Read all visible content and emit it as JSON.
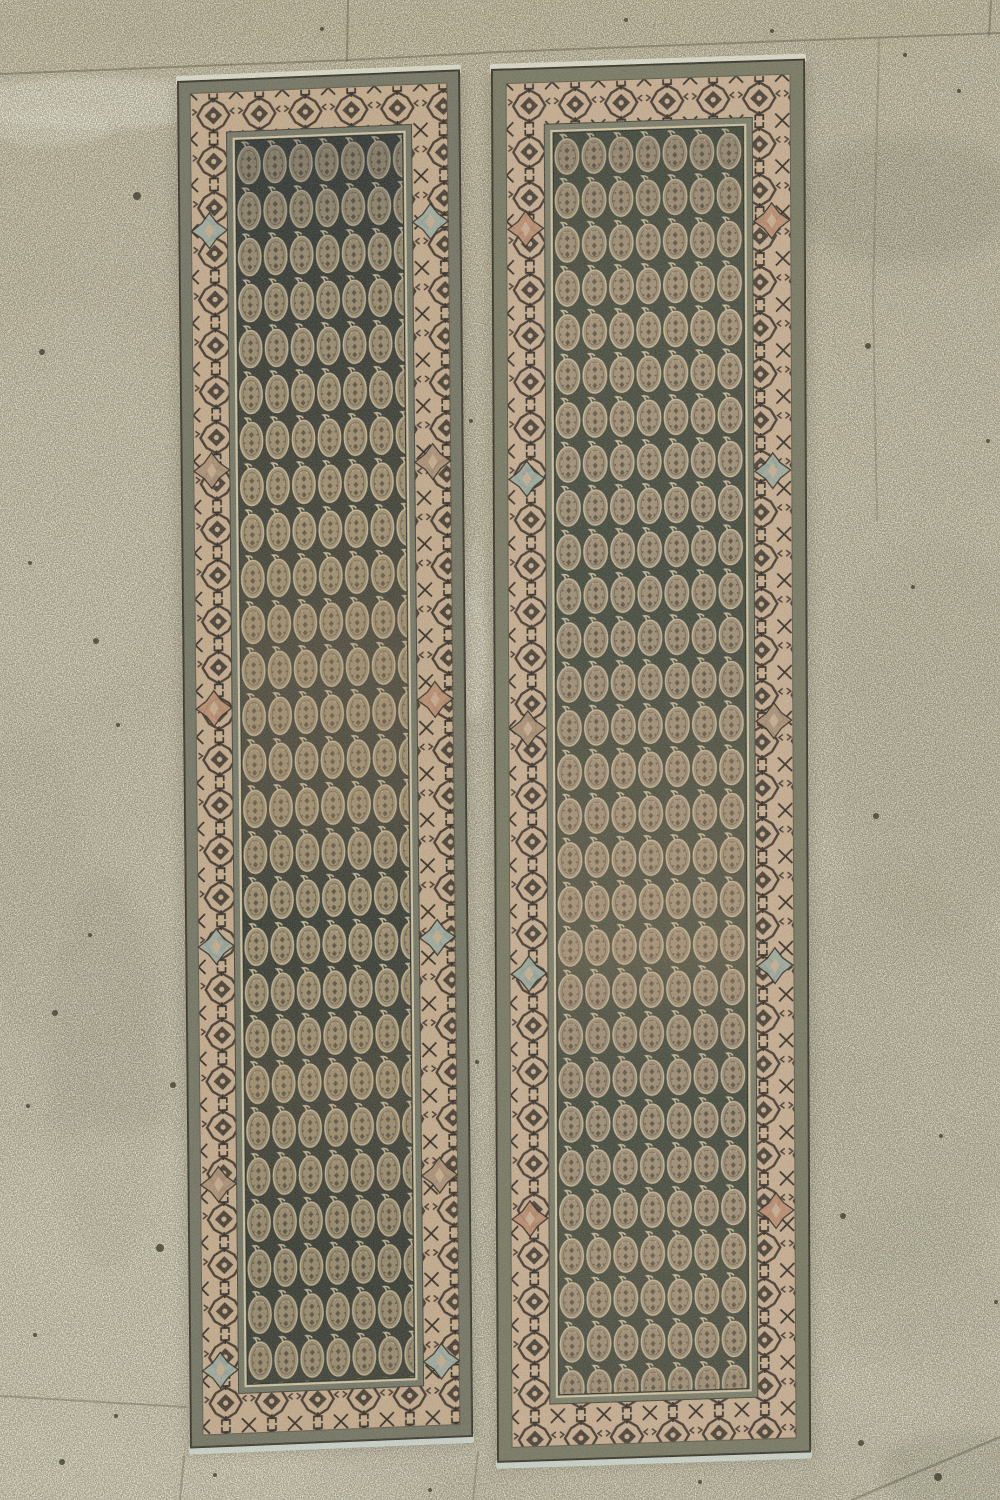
{
  "meta": {
    "description": "Photograph of a pair of antique Persian paisley-pattern runner rugs lying side by side on a speckled concrete floor",
    "canvas_width": 1000,
    "canvas_height": 1500
  },
  "floor": {
    "gradient": [
      "#b0a786",
      "#b6b094",
      "#bdb89f"
    ],
    "grout_color": "#5f5c49",
    "grout_lines": [
      {
        "points": [
          [
            0,
            74
          ],
          [
            350,
            60
          ],
          [
            500,
            52
          ],
          [
            760,
            42
          ],
          [
            1000,
            33
          ]
        ],
        "width": 2,
        "opacity": 0.5
      },
      {
        "points": [
          [
            348,
            0
          ],
          [
            347,
            61
          ]
        ],
        "width": 2,
        "opacity": 0.5
      },
      {
        "points": [
          [
            879,
            40
          ],
          [
            873,
            300
          ],
          [
            877,
            520
          ]
        ],
        "width": 2,
        "opacity": 0.3
      },
      {
        "points": [
          [
            991,
            0
          ],
          [
            989,
            35
          ]
        ],
        "width": 2,
        "opacity": 0.5
      },
      {
        "points": [
          [
            0,
            1396
          ],
          [
            186,
            1407
          ]
        ],
        "width": 2,
        "opacity": 0.4
      },
      {
        "points": [
          [
            184,
            1456
          ],
          [
            180,
            1500
          ]
        ],
        "width": 2,
        "opacity": 0.4
      },
      {
        "points": [
          [
            478,
            1452
          ],
          [
            473,
            1500
          ]
        ],
        "width": 2,
        "opacity": 0.35
      },
      {
        "points": [
          [
            852,
            1500
          ],
          [
            1000,
            1437
          ]
        ],
        "width": 2.5,
        "opacity": 0.45
      }
    ],
    "patches": [
      {
        "cx": 95,
        "cy": 103,
        "rx": 130,
        "ry": 26,
        "c": "#e6e3d2",
        "o": 0.55,
        "b": 8
      },
      {
        "cx": 52,
        "cy": 128,
        "rx": 60,
        "ry": 18,
        "c": "#e6e3d2",
        "o": 0.4,
        "b": 8
      },
      {
        "cx": 905,
        "cy": 200,
        "rx": 110,
        "ry": 65,
        "c": "#65624a",
        "o": 0.3,
        "b": 24
      },
      {
        "cx": 700,
        "cy": 160,
        "rx": 60,
        "ry": 30,
        "c": "#6e6b51",
        "o": 0.12,
        "b": 24
      },
      {
        "cx": 60,
        "cy": 500,
        "rx": 110,
        "ry": 200,
        "c": "#c6c0a4",
        "o": 0.3,
        "b": 32
      },
      {
        "cx": 935,
        "cy": 740,
        "rx": 110,
        "ry": 200,
        "c": "#83805f",
        "o": 0.22,
        "b": 32
      },
      {
        "cx": 890,
        "cy": 1080,
        "rx": 130,
        "ry": 220,
        "c": "#83805f",
        "o": 0.16,
        "b": 32
      },
      {
        "cx": 105,
        "cy": 1075,
        "rx": 55,
        "ry": 200,
        "c": "#6f6c52",
        "o": 0.22,
        "b": 24
      },
      {
        "cx": 25,
        "cy": 880,
        "rx": 60,
        "ry": 150,
        "c": "#83805f",
        "o": 0.15,
        "b": 24
      },
      {
        "cx": 120,
        "cy": 1340,
        "rx": 240,
        "ry": 210,
        "c": "#ccc7ac",
        "o": 0.42,
        "b": 32
      },
      {
        "cx": 640,
        "cy": 1490,
        "rx": 230,
        "ry": 30,
        "c": "#a29a77",
        "o": 0.25,
        "b": 16
      },
      {
        "cx": 965,
        "cy": 1475,
        "rx": 85,
        "ry": 45,
        "c": "#6a674e",
        "o": 0.3,
        "b": 16
      },
      {
        "cx": 472,
        "cy": 655,
        "rx": 17,
        "ry": 65,
        "c": "#ded9c5",
        "o": 0.5,
        "b": 8
      },
      {
        "cx": 473,
        "cy": 580,
        "rx": 12,
        "ry": 40,
        "c": "#d5d1bd",
        "o": 0.35,
        "b": 8
      },
      {
        "cx": 500,
        "cy": 18,
        "rx": 540,
        "ry": 34,
        "c": "#9e9370",
        "o": 0.22,
        "b": 16
      },
      {
        "cx": 240,
        "cy": 1480,
        "rx": 200,
        "ry": 30,
        "c": "#c9c4a9",
        "o": 0.3,
        "b": 16
      },
      {
        "cx": 360,
        "cy": 55,
        "rx": 180,
        "ry": 18,
        "c": "#b4a685",
        "o": 0.2,
        "b": 16
      },
      {
        "cx": 30,
        "cy": 300,
        "rx": 50,
        "ry": 80,
        "c": "#a89f7d",
        "o": 0.15,
        "b": 24
      },
      {
        "cx": 860,
        "cy": 420,
        "rx": 70,
        "ry": 90,
        "c": "#b9b397",
        "o": 0.2,
        "b": 24
      },
      {
        "cx": 915,
        "cy": 1280,
        "rx": 90,
        "ry": 90,
        "c": "#8a8666",
        "o": 0.12,
        "b": 24
      }
    ],
    "specks": [
      [
        137,
        196,
        4
      ],
      [
        42,
        352,
        3
      ],
      [
        30,
        563,
        2
      ],
      [
        96,
        641,
        3
      ],
      [
        55,
        1013,
        3
      ],
      [
        160,
        1248,
        4
      ],
      [
        173,
        1085,
        3
      ],
      [
        28,
        1106,
        2
      ],
      [
        116,
        1416,
        2
      ],
      [
        62,
        1462,
        3
      ],
      [
        868,
        346,
        3
      ],
      [
        988,
        441,
        2
      ],
      [
        913,
        587,
        2
      ],
      [
        876,
        816,
        3
      ],
      [
        941,
        1136,
        2
      ],
      [
        843,
        1216,
        3
      ],
      [
        938,
        1477,
        4
      ],
      [
        861,
        1443,
        3
      ],
      [
        996,
        1302,
        2
      ],
      [
        471,
        421,
        2
      ],
      [
        477,
        1062,
        2
      ],
      [
        322,
        29,
        2
      ],
      [
        626,
        20,
        2
      ],
      [
        959,
        91,
        2
      ],
      [
        772,
        31,
        2
      ],
      [
        905,
        55,
        2
      ],
      [
        118,
        725,
        2
      ],
      [
        90,
        935,
        2
      ],
      [
        35,
        1335,
        2
      ],
      [
        215,
        1475,
        2
      ],
      [
        700,
        1482,
        2
      ],
      [
        430,
        1490,
        2
      ]
    ],
    "speck_color": "#32301f"
  },
  "rugs": [
    {
      "name": "left-runner-rug",
      "x": 178,
      "y": 82,
      "width": 281,
      "height": 1366,
      "skew_y": -2.35,
      "skew_x": 0.55,
      "layout": {
        "outer_inset": 12,
        "border_side": 36,
        "border_end": 40,
        "guard": 9
      },
      "boteh": {
        "tile_w": 26,
        "tile_h": 46
      },
      "colors": {
        "outline": "#39342a",
        "selvage_top": "#dedfd0",
        "selvage_bottom": "#ccd6ce",
        "shadow": "#3a3426",
        "outer_band": "#6e7060",
        "inner_band": "#6f7363",
        "border_bg": "#c6ab8d",
        "motif_dark": "#3a2f26",
        "motif_black": "#27221b",
        "field_bg": "#2e332c",
        "boteh_fill": "#a29272",
        "boteh_line": "#d2c29f",
        "boteh_dot": "#423a2d",
        "field_frame": "#d5c5a3"
      },
      "medallions": {
        "ys": [
          150,
          390,
          628,
          866,
          1104,
          1290
        ],
        "colors": [
          "#9aaba1",
          "#a98d72",
          "#bb8a6c",
          "#9aaba1",
          "#a98d72",
          "#9aaba1"
        ]
      },
      "abrash": [
        [
          0,
          "#141c2c",
          0.28
        ],
        [
          0.1,
          "#141c2c",
          0.1
        ],
        [
          0.3,
          "#8a6f50",
          0.1
        ],
        [
          0.42,
          "#96785a",
          0.26
        ],
        [
          0.55,
          "#96785a",
          0.2
        ],
        [
          0.63,
          "#3c3c32",
          0.06
        ],
        [
          0.76,
          "#8a6f50",
          0.16
        ],
        [
          0.9,
          "#20261f",
          0.12
        ],
        [
          1,
          "#5c5240",
          0.14
        ]
      ]
    },
    {
      "name": "right-runner-rug",
      "x": 492,
      "y": 70,
      "width": 312,
      "height": 1392,
      "skew_y": -1.9,
      "skew_x": 0.25,
      "layout": {
        "outer_inset": 14,
        "border_side": 38,
        "border_end": 42,
        "guard": 9
      },
      "boteh": {
        "tile_w": 27,
        "tile_h": 44
      },
      "colors": {
        "outline": "#39342a",
        "selvage_top": "#dedfd0",
        "selvage_bottom": "#ccd6ce",
        "shadow": "#3a3426",
        "outer_band": "#73755f",
        "inner_band": "#777a66",
        "border_bg": "#c9ae92",
        "motif_dark": "#3d322a",
        "motif_black": "#2a241d",
        "field_bg": "#3a4136",
        "boteh_fill": "#a6937a",
        "boteh_line": "#d6c5a3",
        "boteh_dot": "#453c2f",
        "field_frame": "#d5c5a3"
      },
      "medallions": {
        "ys": [
          160,
          410,
          660,
          905,
          1150,
          1345
        ],
        "colors": [
          "#bb8a6c",
          "#9aaba1",
          "#a98d72",
          "#9aaba1",
          "#bb8a6c",
          "#9aaba1"
        ]
      },
      "abrash": [
        [
          0,
          "#2a3028",
          0.18
        ],
        [
          0.15,
          "#8d7a58",
          0.1
        ],
        [
          0.35,
          "#3e443a",
          0.08
        ],
        [
          0.5,
          "#9a7f60",
          0.18
        ],
        [
          0.66,
          "#a98a68",
          0.26
        ],
        [
          0.78,
          "#4a493c",
          0.1
        ],
        [
          0.9,
          "#8d7a58",
          0.14
        ],
        [
          1,
          "#6b5f4a",
          0.16
        ]
      ]
    }
  ]
}
